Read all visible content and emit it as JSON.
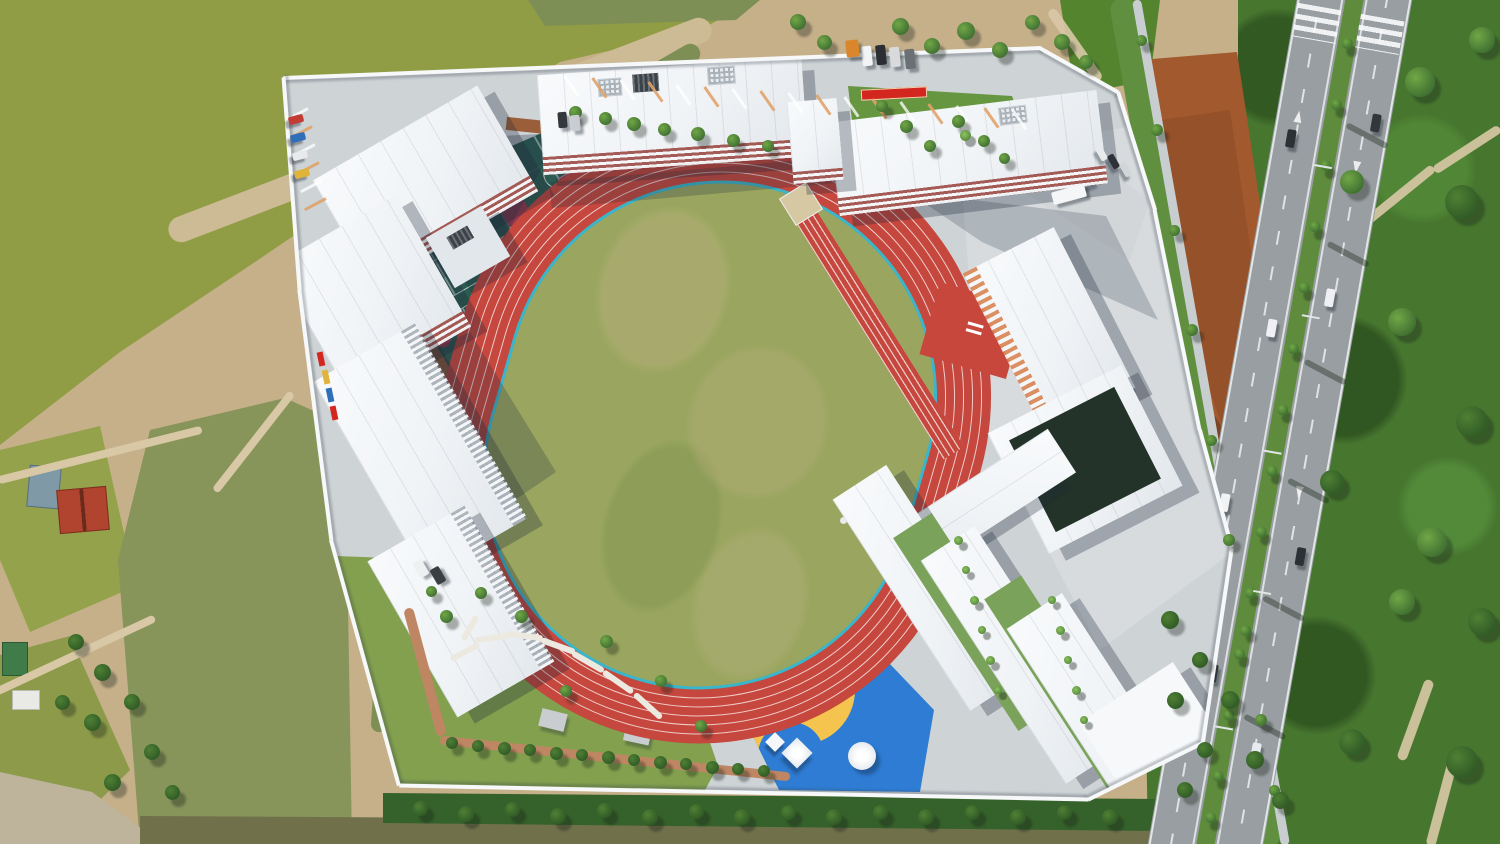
{
  "scene": {
    "type": "aerial-drone-photo",
    "subject": "new school campus seen from directly above: red running track with grass infield and long-jump runway, teal basketball court block with blue-and-yellow play zone, white school buildings, entrance road with tree median, fish ponds to the west, forest to the east",
    "width": 1500,
    "height": 844
  },
  "palette": {
    "pond-bright": "#909d45",
    "pond-mid": "#95a24c",
    "pond-murky": "#87945a",
    "pond-low": "#8c9a4a",
    "channel": "#7e8f55",
    "water-bottom": "#70714b",
    "dirt": "#c6b08a",
    "dirt-light": "#d8c8a6",
    "dirt-bank": "#cdbb95",
    "rock": "#bdb49b",
    "rust-dirt": "#a2592e",
    "rust-dark": "#8a4a26",
    "rubble": "#cdbba0",
    "forest": "#47772f",
    "forest-dark": "#35612a",
    "leaf-light": "#71a746",
    "leaf-dark": "#2f5d2b",
    "grass-band": "#5f8f3f",
    "lawn": "#66963f",
    "garden-green": "#82a04e",
    "road": "#989ea1",
    "road-median": "#5e8c3c",
    "sidewalk": "#c8cdd0",
    "campus": "#ced3d6",
    "plaza": "#d7dbde",
    "roof": "#f3f5f7",
    "roof-shade": "#e2e7eb",
    "facade-red": "#9c4a44",
    "louver-orange": "#d98a5a",
    "court-teal": "#2c5b51",
    "court-red": "#93384d",
    "court-bright": "#e05b4a",
    "mint": "#5ec48e",
    "track-red": "#c5473d",
    "track-edge": "#3ab5c9",
    "infield": "#9aa65f",
    "play-blue": "#2b63c9",
    "play-blue-dark": "#1e4fae",
    "play-cyan": "#45b8d8",
    "play-yellow": "#f4c44e",
    "play-brown": "#8d5c35",
    "wall": "#f7f8f9",
    "banner-red": "#d3261f",
    "brick-path": "#bf8663",
    "path-white": "#eceae0",
    "walkway-brown": "#9a5f3a"
  },
  "track": {
    "lanes": 6,
    "lane_width_px": 9,
    "rotation_deg": 16,
    "outer_radius_px": 270,
    "infield_inset_px": 54
  },
  "courts": {
    "rows": 3,
    "cols": 2,
    "cell_w": 132,
    "cell_h": 108,
    "origin_x": 14,
    "origin_y": 26,
    "gap_x": 16,
    "gap_y": 16,
    "extra_rects": [
      [
        18,
        6,
        60,
        30
      ],
      [
        228,
        86,
        52,
        62
      ],
      [
        10,
        382,
        58,
        28
      ]
    ],
    "spots": [
      [
        150,
        62
      ],
      [
        70,
        252
      ],
      [
        210,
        332
      ],
      [
        40,
        160
      ]
    ]
  },
  "walls": {
    "points": [
      [
        283,
        78
      ],
      [
        1040,
        48
      ],
      [
        1118,
        92
      ],
      [
        1155,
        210
      ],
      [
        1200,
        430
      ],
      [
        1232,
        548
      ],
      [
        1203,
        743
      ],
      [
        1088,
        800
      ],
      [
        399,
        786
      ],
      [
        331,
        540
      ],
      [
        299,
        290
      ],
      [
        283,
        78
      ]
    ]
  },
  "strips0": [
    [
      440,
      130,
      580,
      -21,
      26,
      "dirt-bank",
      1
    ],
    [
      575,
      120,
      285,
      -30,
      20,
      "channel",
      1
    ],
    [
      445,
      300,
      215,
      -65,
      18,
      "channel",
      1
    ],
    [
      390,
      560,
      345,
      -86,
      16,
      "channel",
      1
    ],
    [
      100,
      455,
      210,
      -14,
      8,
      "dirt-light",
      1
    ],
    [
      75,
      655,
      175,
      -25,
      8,
      "dirt-light",
      1
    ],
    [
      253,
      442,
      125,
      -52,
      8,
      "dirt-light",
      1
    ],
    [
      1196,
      422,
      862,
      80,
      26,
      "grass-band",
      1
    ],
    [
      1211,
      422,
      858,
      80,
      9,
      "sidewalk",
      1
    ],
    [
      1467,
      149,
      78,
      147,
      9,
      "dirt-light",
      0.9
    ],
    [
      1396,
      197,
      95,
      141,
      9,
      "dirt-light",
      0.9
    ],
    [
      1337,
      262,
      85,
      120,
      9,
      "dirt-light",
      0.9
    ],
    [
      1308,
      335,
      60,
      100,
      9,
      "dirt-light",
      0.9
    ],
    [
      1415,
      720,
      85,
      110,
      10,
      "dirt-light",
      0.9
    ],
    [
      1442,
      800,
      95,
      105,
      10,
      "dirt-light",
      0.9
    ],
    [
      1075,
      45,
      86,
      55,
      10,
      "dirt-light",
      0.9
    ]
  ],
  "strips1": [
    [
      465,
      652,
      32,
      -28,
      6,
      "path-white",
      1
    ],
    [
      492,
      638,
      36,
      -8,
      6,
      "path-white",
      1
    ],
    [
      525,
      636,
      36,
      8,
      6,
      "path-white",
      1
    ],
    [
      558,
      646,
      36,
      20,
      6,
      "path-white",
      1
    ],
    [
      588,
      662,
      36,
      30,
      6,
      "path-white",
      1
    ],
    [
      618,
      682,
      36,
      35,
      6,
      "path-white",
      1
    ],
    [
      648,
      706,
      36,
      42,
      6,
      "path-white",
      1
    ],
    [
      470,
      628,
      28,
      -60,
      6,
      "path-white",
      1
    ],
    [
      425,
      672,
      132,
      75,
      10,
      "brick-path",
      1
    ],
    [
      615,
      758,
      352,
      6,
      9,
      "brick-path",
      1
    ]
  ],
  "trees": {
    "groups": [
      {
        "name": "north-green-band",
        "dark": false,
        "items": [
          [
            575,
            112,
            13
          ],
          [
            605,
            118,
            13
          ],
          [
            634,
            124,
            14
          ],
          [
            664,
            129,
            13
          ],
          [
            698,
            134,
            14
          ],
          [
            733,
            140,
            13
          ],
          [
            768,
            146,
            12
          ]
        ]
      },
      {
        "name": "ne-lawn",
        "dark": false,
        "items": [
          [
            882,
            106,
            12
          ],
          [
            906,
            126,
            13
          ],
          [
            930,
            146,
            12
          ],
          [
            958,
            121,
            13
          ],
          [
            984,
            141,
            12
          ],
          [
            1004,
            158,
            11
          ]
        ]
      },
      {
        "name": "outside-ne",
        "dark": false,
        "items": [
          [
            798,
            22,
            16
          ],
          [
            824,
            42,
            15
          ],
          [
            900,
            26,
            17
          ],
          [
            932,
            46,
            16
          ],
          [
            966,
            31,
            18
          ],
          [
            1000,
            50,
            16
          ],
          [
            1032,
            22,
            15
          ],
          [
            1062,
            42,
            16
          ],
          [
            1086,
            62,
            14
          ]
        ]
      },
      {
        "name": "garden",
        "dark": false,
        "items": [
          [
            446,
            616,
            13
          ],
          [
            481,
            593,
            12
          ],
          [
            521,
            616,
            13
          ],
          [
            566,
            691,
            12
          ],
          [
            606,
            641,
            13
          ],
          [
            661,
            681,
            12
          ],
          [
            701,
            726,
            12
          ],
          [
            431,
            591,
            11
          ]
        ]
      },
      {
        "name": "garden-row",
        "dark": true,
        "items": [
          [
            452,
            743,
            12
          ],
          [
            478,
            746,
            12
          ],
          [
            504,
            748,
            13
          ],
          [
            530,
            750,
            12
          ],
          [
            556,
            753,
            13
          ],
          [
            582,
            755,
            12
          ],
          [
            608,
            757,
            13
          ],
          [
            634,
            760,
            12
          ],
          [
            660,
            762,
            13
          ],
          [
            686,
            764,
            12
          ],
          [
            712,
            767,
            13
          ],
          [
            738,
            769,
            12
          ],
          [
            764,
            771,
            12
          ]
        ]
      },
      {
        "name": "roadside-band",
        "dark": false,
        "items": [
          [
            1141,
            40,
            11
          ],
          [
            1157,
            130,
            12
          ],
          [
            1174,
            230,
            11
          ],
          [
            1192,
            330,
            12
          ],
          [
            1211,
            440,
            11
          ],
          [
            1229,
            540,
            12
          ],
          [
            1245,
            630,
            11
          ],
          [
            1261,
            720,
            12
          ],
          [
            1274,
            790,
            11
          ]
        ]
      },
      {
        "name": "south-tree-band",
        "dark": true,
        "items": [
          [
            420,
            808,
            15
          ],
          [
            466,
            814,
            16
          ],
          [
            512,
            809,
            15
          ],
          [
            558,
            816,
            16
          ],
          [
            604,
            810,
            15
          ],
          [
            650,
            817,
            16
          ],
          [
            696,
            811,
            15
          ],
          [
            742,
            817,
            16
          ],
          [
            788,
            812,
            15
          ],
          [
            834,
            817,
            16
          ],
          [
            880,
            812,
            15
          ],
          [
            926,
            817,
            16
          ],
          [
            972,
            812,
            15
          ],
          [
            1018,
            817,
            16
          ],
          [
            1064,
            812,
            15
          ],
          [
            1110,
            817,
            16
          ]
        ]
      },
      {
        "name": "pond-side-trees",
        "dark": true,
        "items": [
          [
            76,
            642,
            16
          ],
          [
            102,
            672,
            17
          ],
          [
            132,
            702,
            16
          ],
          [
            92,
            722,
            17
          ],
          [
            152,
            752,
            16
          ],
          [
            112,
            782,
            17
          ],
          [
            172,
            792,
            15
          ],
          [
            62,
            702,
            15
          ]
        ]
      },
      {
        "name": "se-outside-trees",
        "dark": true,
        "items": [
          [
            1170,
            620,
            18
          ],
          [
            1200,
            660,
            16
          ],
          [
            1175,
            700,
            17
          ],
          [
            1230,
            700,
            18
          ],
          [
            1205,
            750,
            16
          ],
          [
            1255,
            760,
            18
          ],
          [
            1185,
            790,
            16
          ],
          [
            1280,
            800,
            17
          ]
        ]
      },
      {
        "name": "forest-mottle",
        "dark": false,
        "items": [
          [
            1420,
            82,
            30
          ],
          [
            1462,
            202,
            34
          ],
          [
            1402,
            322,
            28
          ],
          [
            1472,
            422,
            32
          ],
          [
            1432,
            542,
            30
          ],
          [
            1482,
            622,
            28
          ],
          [
            1402,
            602,
            26
          ],
          [
            1462,
            762,
            32
          ],
          [
            1352,
            182,
            24
          ],
          [
            1332,
            482,
            24
          ],
          [
            1482,
            40,
            26
          ],
          [
            1352,
            742,
            26
          ]
        ]
      }
    ]
  },
  "palms": [
    [
      958,
      540,
      9
    ],
    [
      966,
      570,
      8
    ],
    [
      974,
      600,
      9
    ],
    [
      982,
      630,
      8
    ],
    [
      990,
      660,
      9
    ],
    [
      998,
      690,
      8
    ],
    [
      1052,
      600,
      8
    ],
    [
      1060,
      630,
      9
    ],
    [
      1068,
      660,
      8
    ],
    [
      1076,
      690,
      9
    ],
    [
      1084,
      720,
      8
    ],
    [
      965,
      135,
      11
    ]
  ],
  "road": {
    "median_tree_ys": [
      50,
      112,
      174,
      236,
      298,
      360,
      422,
      484,
      546,
      608,
      670,
      732,
      794,
      836
    ],
    "shadow_streaks": [
      [
        70,
        140
      ],
      [
        72,
        260
      ],
      [
        70,
        380
      ],
      [
        74,
        500
      ],
      [
        70,
        620
      ],
      [
        72,
        740
      ]
    ],
    "cars": [
      [
        14,
        150,
        "#2c3136"
      ],
      [
        28,
        340,
        "#eef0f3"
      ],
      [
        12,
        520,
        "#f0f2f4"
      ],
      [
        30,
        690,
        "#30353a"
      ],
      [
        95,
        120,
        "#32373c"
      ],
      [
        80,
        300,
        "#eef0f3"
      ],
      [
        96,
        560,
        "#2c3136"
      ],
      [
        86,
        760,
        "#e8ebee"
      ]
    ],
    "lights": [
      [
        46,
        180
      ],
      [
        60,
        330
      ],
      [
        46,
        470
      ],
      [
        60,
        610
      ],
      [
        46,
        750
      ]
    ]
  },
  "parking": {
    "north": {
      "x1": 570,
      "y1": 74,
      "x2": 1018,
      "y2": 108,
      "count": 17,
      "rot": -35
    },
    "west": {
      "x1": 296,
      "y1": 102,
      "x2": 314,
      "y2": 192,
      "count": 6,
      "rot": 62
    }
  },
  "cars": [
    [
      862,
      46,
      10,
      20,
      -6,
      "#f2f4f6"
    ],
    [
      876,
      45,
      10,
      20,
      -6,
      "#2b2f33"
    ],
    [
      890,
      47,
      10,
      20,
      -6,
      "#d8dadc"
    ],
    [
      905,
      49,
      10,
      20,
      -6,
      "#6b7074"
    ],
    [
      846,
      40,
      13,
      17,
      -6,
      "#d9862c"
    ],
    [
      558,
      112,
      9,
      16,
      -5,
      "#33383c"
    ],
    [
      571,
      115,
      9,
      16,
      -5,
      "#c9ccd0"
    ],
    [
      1052,
      188,
      34,
      13,
      -15,
      "#f4f6f7"
    ],
    [
      416,
      560,
      10,
      17,
      -30,
      "#eef0f2"
    ],
    [
      433,
      567,
      10,
      17,
      -30,
      "#3a3f44"
    ],
    [
      1094,
      150,
      15,
      7,
      60,
      "#e8eaec"
    ],
    [
      1106,
      158,
      15,
      7,
      60,
      "#2e3237"
    ],
    [
      1118,
      166,
      15,
      7,
      60,
      "#d2d5d8"
    ],
    [
      292,
      112,
      8,
      15,
      75,
      "#c23b35"
    ],
    [
      294,
      130,
      8,
      15,
      75,
      "#2f6fba"
    ],
    [
      296,
      148,
      8,
      15,
      75,
      "#e8eaec"
    ],
    [
      298,
      166,
      8,
      15,
      75,
      "#e0b43a"
    ]
  ],
  "wall_flags": [
    [
      318,
      352,
      "#d3261f"
    ],
    [
      323,
      370,
      "#e0b43a"
    ],
    [
      327,
      388,
      "#2f6fba"
    ],
    [
      331,
      406,
      "#d3261f"
    ]
  ]
}
